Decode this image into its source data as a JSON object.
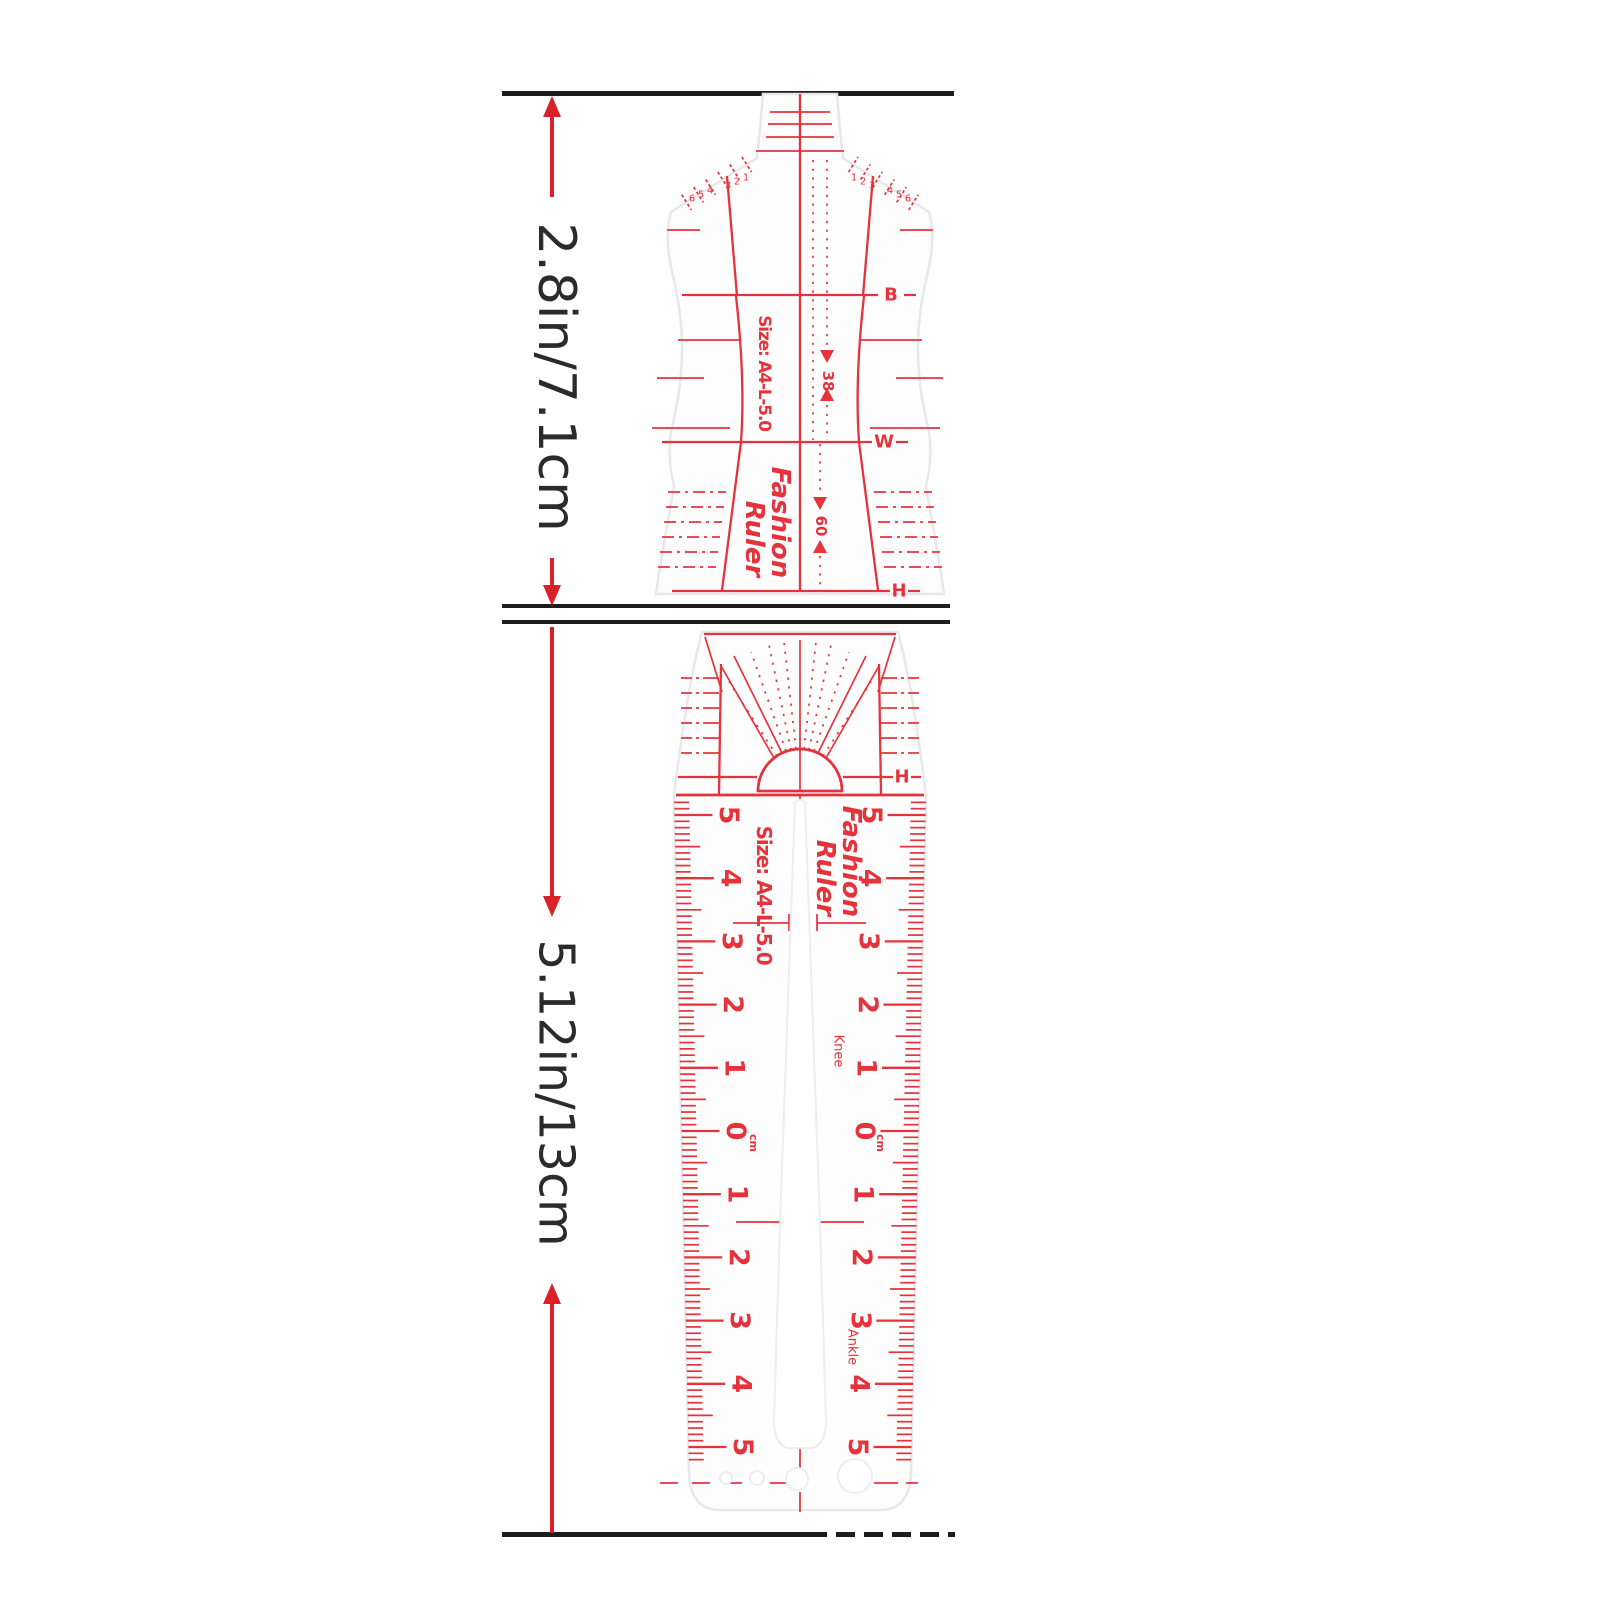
{
  "annotations": {
    "top_section_height": "2.8in/7.1cm",
    "bottom_section_height": "5.12in/13cm"
  },
  "top_ruler": {
    "size_label": "Size: A4-L-5.0",
    "brand_line1": "Fashion",
    "brand_line2": "Ruler",
    "bust_label": "B",
    "waist_label": "W",
    "hip_label": "H",
    "bust_value": "38",
    "hip_value": "60",
    "shoulder_numbers_left": [
      "6",
      "5",
      "4",
      "3",
      "2",
      "1"
    ],
    "shoulder_numbers_right": [
      "1",
      "2",
      "3",
      "4",
      "5",
      "6"
    ]
  },
  "bottom_ruler": {
    "size_label": "Size: A4-L-5.0",
    "brand_line1": "Fashion",
    "brand_line2": "Ruler",
    "hip_label": "H",
    "knee_label": "Knee",
    "ankle_label": "Ankle",
    "unit_label": "cm",
    "scale_numbers": [
      "5",
      "4",
      "3",
      "2",
      "1",
      "0",
      "1",
      "2",
      "3",
      "4",
      "5"
    ]
  },
  "colors": {
    "marking_red": "#e5333c",
    "arrow_red": "#da2127",
    "line_black": "#1d1d1d",
    "dimension_text": "#2b2b2b"
  }
}
